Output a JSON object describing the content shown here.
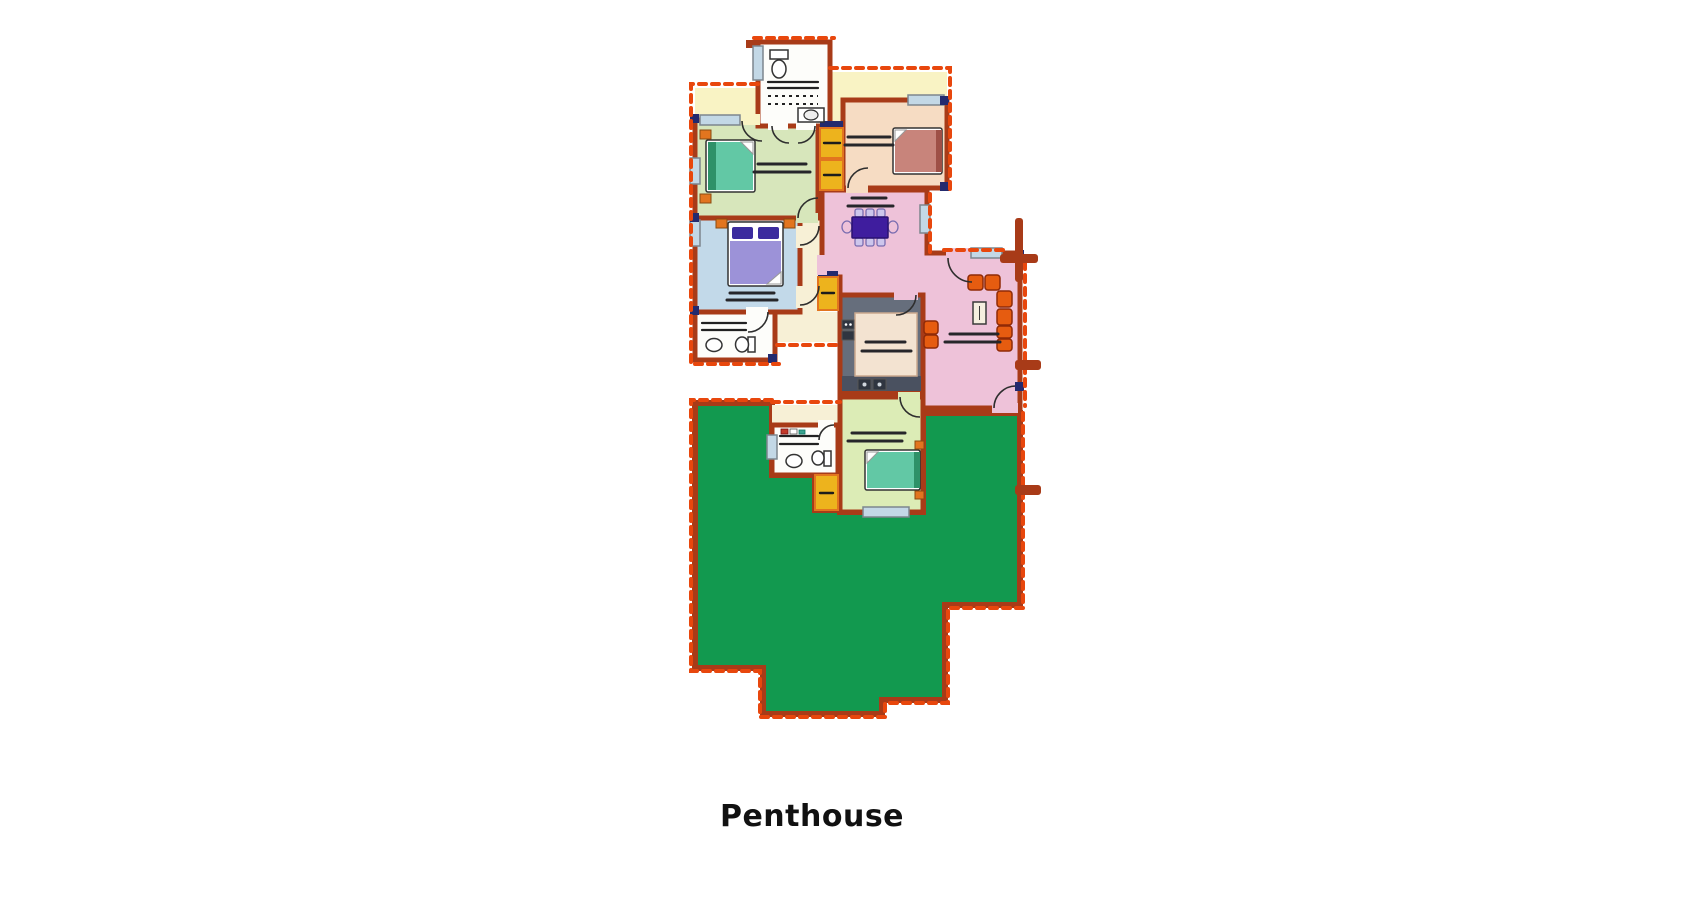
{
  "title": "Penthouse",
  "colors": {
    "wall": "#a83b18",
    "dash": "#e8470d",
    "terrace": "#12994f",
    "balcony": "#f9f3c4",
    "hall": "#f7f0d6",
    "bathroom": "#fdfdfa",
    "bedroom_green": "#d7e6bb",
    "bedroom_blue": "#c2d9e9",
    "bedroom_peach": "#f6dcc3",
    "bedroom_small": "#dcecb6",
    "living_pink": "#eec2d9",
    "kitchen_gray": "#666e7c",
    "kitchen_band": "#4a5160",
    "island": "#f3e3d1",
    "wardrobe": "#edb31d",
    "wardrobe_accent": "#e2751f",
    "bed_teal": "#62c8a5",
    "bed_teal_dark": "#2e9168",
    "bed_lavender": "#9c92d8",
    "bed_pillow_indigo": "#3b2b9e",
    "bed_rose": "#c8847b",
    "bed_rose_dark": "#9e4f46",
    "sofa_orange": "#e65c10",
    "sofa_outline": "#8f2a07",
    "table_indigo": "#3f1d9e",
    "chair_lilac": "#cdc6ec",
    "window_glass": "#c3d8e6",
    "rug": "#26262a",
    "navy": "#232a6e",
    "title_color": "#111111"
  },
  "floorplan": {
    "level_label": "Penthouse",
    "areas": [
      "terrace",
      "living-room",
      "dining-area",
      "kitchen",
      "bedroom-top-left",
      "bedroom-top-right",
      "bedroom-middle-left",
      "bedroom-bottom",
      "bathroom-top",
      "bathroom-middle",
      "bathroom-bottom",
      "hallway",
      "balcony-top-left",
      "balcony-top-right",
      "wardrobes"
    ]
  }
}
